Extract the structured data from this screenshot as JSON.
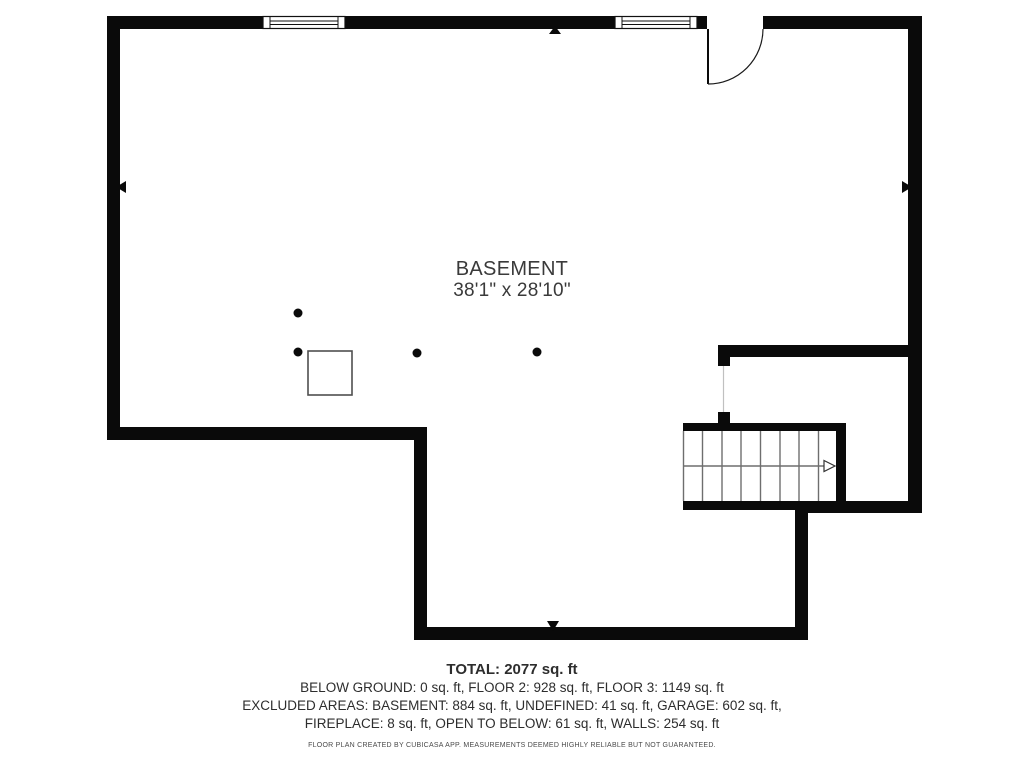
{
  "floor_plan": {
    "room": {
      "name": "BASEMENT",
      "dimensions": "38'1\" x 28'10\""
    },
    "summary": {
      "total": "TOTAL: 2077 sq. ft",
      "floors": "BELOW GROUND: 0 sq. ft, FLOOR 2: 928 sq. ft, FLOOR 3: 1149 sq. ft",
      "excluded_line_1": "EXCLUDED AREAS: BASEMENT: 884 sq. ft, UNDEFINED: 41 sq. ft, GARAGE: 602 sq. ft,",
      "excluded_line_2": "FIREPLACE: 8 sq. ft, OPEN TO BELOW: 61 sq. ft, WALLS: 254 sq. ft"
    },
    "disclaimer": "FLOOR PLAN CREATED BY CUBICASA APP. MEASUREMENTS DEEMED HIGHLY RELIABLE BUT NOT GUARANTEED.",
    "colors": {
      "wall": "#0a0a0a",
      "background": "#ffffff",
      "stair_line": "#6e6e6e",
      "fixture_outline": "#4f4f4f",
      "text": "#2d2d2d"
    },
    "symbols": {
      "windows": 2,
      "doors": 1,
      "support_columns": 4,
      "stair_treads": 8
    }
  }
}
